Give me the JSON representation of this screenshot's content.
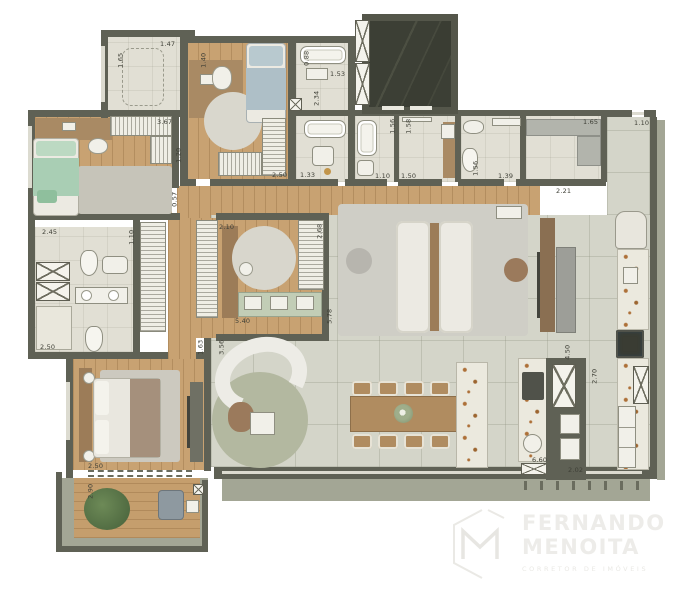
{
  "logo": {
    "line1": "FERNANDO",
    "line2": "MENOITA",
    "tagline": "CORRETOR DE IMÓVEIS"
  },
  "palette": {
    "wall": "#5f6155",
    "wood_floor": "#c8a272",
    "bath_tile": "#e1dfd4",
    "living_floor": "#d4d5c9",
    "terrace": "#a3a695",
    "marble_counter": "#ebe9de",
    "green_bed": "#a9ceb4",
    "blue_bed": "#aebfc7",
    "green_rug": "#b3b8a0"
  },
  "dimensions": [
    {
      "t": "1.65",
      "x": 113,
      "y": 57,
      "o": "v"
    },
    {
      "t": "1.47",
      "x": 160,
      "y": 41,
      "o": "h"
    },
    {
      "t": "1.40",
      "x": 196,
      "y": 57,
      "o": "v"
    },
    {
      "t": "0.88",
      "x": 299,
      "y": 55,
      "o": "v"
    },
    {
      "t": "1.53",
      "x": 330,
      "y": 71,
      "o": "h"
    },
    {
      "t": "2.34",
      "x": 309,
      "y": 95,
      "o": "v"
    },
    {
      "t": "1.56",
      "x": 385,
      "y": 123,
      "o": "v"
    },
    {
      "t": "1.58",
      "x": 401,
      "y": 123,
      "o": "v"
    },
    {
      "t": "1.65",
      "x": 583,
      "y": 119,
      "o": "h"
    },
    {
      "t": "1.10",
      "x": 634,
      "y": 120,
      "o": "h"
    },
    {
      "t": "3.67",
      "x": 157,
      "y": 119,
      "o": "h"
    },
    {
      "t": "1.20",
      "x": 171,
      "y": 152,
      "o": "v"
    },
    {
      "t": "2.50",
      "x": 272,
      "y": 172,
      "o": "h"
    },
    {
      "t": "1.33",
      "x": 300,
      "y": 172,
      "o": "h"
    },
    {
      "t": "1.10",
      "x": 375,
      "y": 173,
      "o": "h"
    },
    {
      "t": "1.50",
      "x": 401,
      "y": 173,
      "o": "h"
    },
    {
      "t": "1.39",
      "x": 498,
      "y": 173,
      "o": "h"
    },
    {
      "t": "1.56",
      "x": 468,
      "y": 165,
      "o": "v"
    },
    {
      "t": "2.21",
      "x": 556,
      "y": 188,
      "o": "h"
    },
    {
      "t": "0.57",
      "x": 167,
      "y": 196,
      "o": "v"
    },
    {
      "t": "2.10",
      "x": 219,
      "y": 224,
      "o": "h"
    },
    {
      "t": "2.68",
      "x": 312,
      "y": 228,
      "o": "v"
    },
    {
      "t": "5.78",
      "x": 322,
      "y": 313,
      "o": "v"
    },
    {
      "t": "5.40",
      "x": 235,
      "y": 318,
      "o": "h"
    },
    {
      "t": "2.45",
      "x": 42,
      "y": 229,
      "o": "h"
    },
    {
      "t": "1.10",
      "x": 124,
      "y": 234,
      "o": "v"
    },
    {
      "t": "2.50",
      "x": 40,
      "y": 344,
      "o": "h"
    },
    {
      "t": "1.63",
      "x": 193,
      "y": 344,
      "o": "v"
    },
    {
      "t": "3.56",
      "x": 214,
      "y": 344,
      "o": "v"
    },
    {
      "t": "2.50",
      "x": 88,
      "y": 463,
      "o": "h"
    },
    {
      "t": "2.90",
      "x": 83,
      "y": 488,
      "o": "v"
    },
    {
      "t": "4.50",
      "x": 560,
      "y": 349,
      "o": "v"
    },
    {
      "t": "2.70",
      "x": 587,
      "y": 373,
      "o": "v"
    },
    {
      "t": "6.60",
      "x": 532,
      "y": 457,
      "o": "h"
    },
    {
      "t": "2.02",
      "x": 568,
      "y": 467,
      "o": "h"
    }
  ]
}
